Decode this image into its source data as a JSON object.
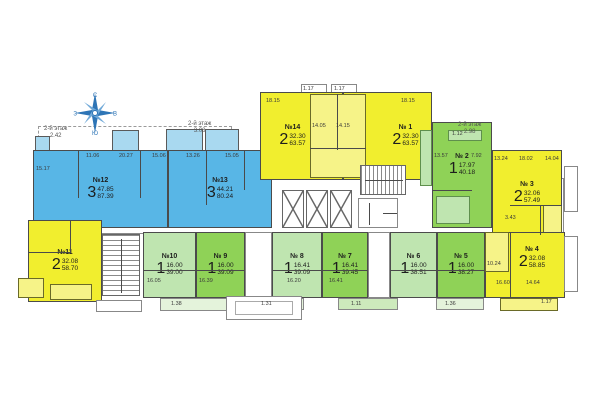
{
  "plan": {
    "type": "residential-floor-plan",
    "floor_notes": [
      {
        "label": "2-й этаж",
        "value": "2.42"
      },
      {
        "label": "2-й этаж",
        "value": "3.08"
      },
      {
        "label": "2-й этаж",
        "value": "2.98"
      }
    ],
    "compass": {
      "north": "С",
      "east": "В",
      "south": "Ю",
      "west": "З"
    }
  },
  "colors": {
    "blue": "#58b6e6",
    "blue_light": "#a9d9f0",
    "yellow": "#f1ee2e",
    "yellow_light": "#f6f388",
    "green": "#8fd257",
    "green_light": "#bfe5b0",
    "wall": "#4b4b4b",
    "compass_blue": "#2e75b6"
  },
  "apartments": [
    {
      "label": "№ 1",
      "rooms": "2",
      "area_living": "32.30",
      "area_total": "63.57"
    },
    {
      "label": "№ 2",
      "rooms": "1",
      "area_living": "17.97",
      "area_total": "40.18"
    },
    {
      "label": "№ 3",
      "rooms": "2",
      "area_living": "32.06",
      "area_total": "57.49"
    },
    {
      "label": "№ 4",
      "rooms": "2",
      "area_living": "32.08",
      "area_total": "58.85"
    },
    {
      "label": "№ 5",
      "rooms": "1",
      "area_living": "16.00",
      "area_total": "38.27"
    },
    {
      "label": "№ 6",
      "rooms": "1",
      "area_living": "16.00",
      "area_total": "38.51"
    },
    {
      "label": "№ 7",
      "rooms": "1",
      "area_living": "16.41",
      "area_total": "39.45"
    },
    {
      "label": "№ 8",
      "rooms": "1",
      "area_living": "16.41",
      "area_total": "39.09"
    },
    {
      "label": "№ 9",
      "rooms": "1",
      "area_living": "16.00",
      "area_total": "39.09"
    },
    {
      "label": "№10",
      "rooms": "1",
      "area_living": "16.00",
      "area_total": "39.00"
    },
    {
      "label": "№11",
      "rooms": "2",
      "area_living": "32.08",
      "area_total": "58.70"
    },
    {
      "label": "№12",
      "rooms": "3",
      "area_living": "47.85",
      "area_total": "87.39"
    },
    {
      "label": "№13",
      "rooms": "3",
      "area_living": "44.21",
      "area_total": "80.24"
    },
    {
      "label": "№14",
      "rooms": "2",
      "area_living": "32.30",
      "area_total": "63.57"
    }
  ],
  "dims": [
    "15.17",
    "11.06",
    "20.27",
    "15.06",
    "13.26",
    "15.05",
    "18.15",
    "14.05",
    "14.15",
    "18.15",
    "1.17",
    "1.17",
    "1.12",
    "13.57",
    "7.92",
    "13.24",
    "18.02",
    "14.04",
    "3.43",
    "16.05",
    "16.39",
    "16.20",
    "16.41",
    "10.24",
    "16.60",
    "14.64",
    "1.38",
    "1.31",
    "1.11",
    "1.36",
    "1.17"
  ]
}
